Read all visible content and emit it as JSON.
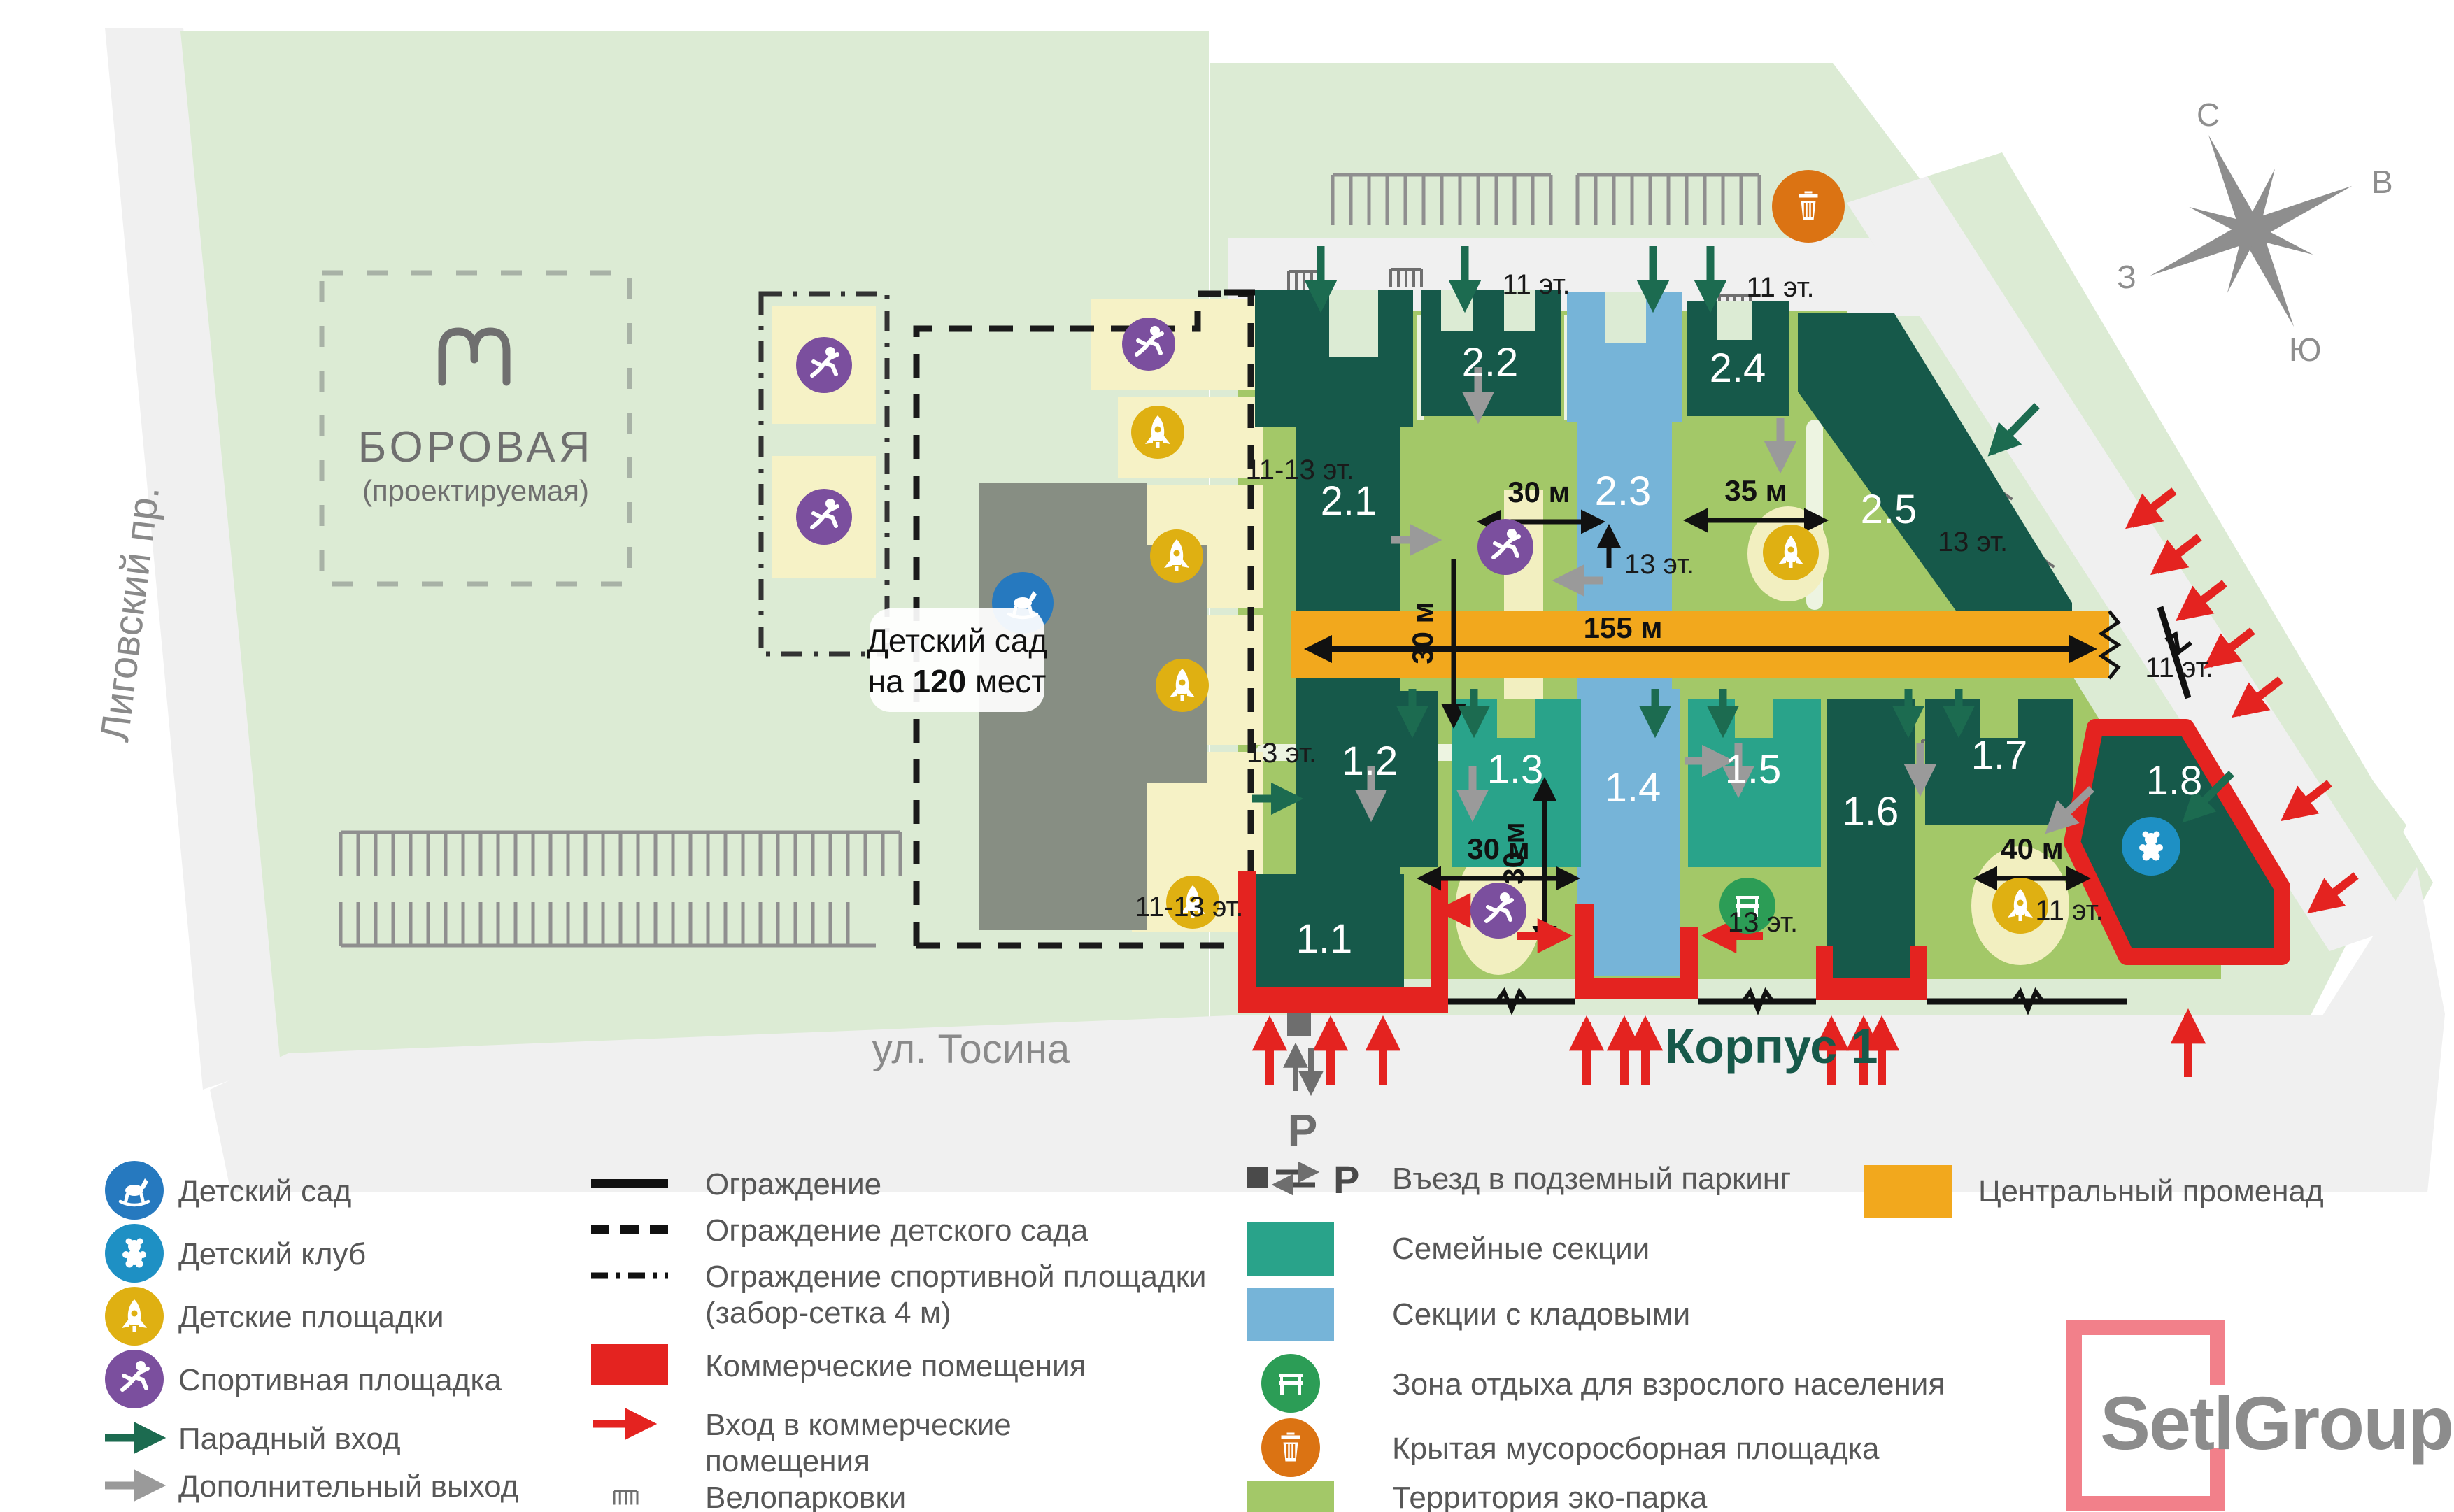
{
  "map": {
    "metro": {
      "name": "БОРОВАЯ",
      "sub": "(проектируемая)"
    },
    "street_left": "Лиговский пр.",
    "street_bottom": "ул. Тосина",
    "korpus": "Корпус 1",
    "kg_line1": "Детский сад",
    "kg_line2a": "на ",
    "kg_line2b": "120",
    "kg_line2c": " мест",
    "parking_letter": "Р",
    "compass": {
      "n": "С",
      "e": "В",
      "s": "Ю",
      "w": "З"
    },
    "building_labels": [
      "2.1",
      "2.2",
      "2.3",
      "2.4",
      "2.5",
      "1.1",
      "1.2",
      "1.3",
      "1.4",
      "1.5",
      "1.6",
      "1.7",
      "1.8"
    ],
    "floor_labels": [
      "11-13 эт.",
      "11-13 эт.",
      "11 эт.",
      "11 эт.",
      "11 эт.",
      "11 эт.",
      "13 эт.",
      "13 эт.",
      "13 эт.",
      "13 эт."
    ],
    "measurements": {
      "m30": "30 м",
      "m35": "35 м",
      "m40": "40 м",
      "m155": "155 м"
    }
  },
  "legend": {
    "col1": [
      {
        "label": "Детский сад"
      },
      {
        "label": "Детский клуб"
      },
      {
        "label": "Детские площадки"
      },
      {
        "label": "Спортивная площадка"
      },
      {
        "label": "Парадный вход"
      },
      {
        "label": "Дополнительный выход"
      }
    ],
    "col2": [
      {
        "label": "Ограждение"
      },
      {
        "label": "Ограждение детского сада"
      },
      {
        "label": "Ограждение спортивной площадки",
        "label2": "(забор-сетка 4 м)"
      },
      {
        "label": "Коммерческие помещения"
      },
      {
        "label": "Вход в коммерческие",
        "label2": "помещения"
      },
      {
        "label": "Велопарковки"
      }
    ],
    "col3": [
      {
        "label": "Въезд в подземный паркинг"
      },
      {
        "label": "Семейные секции"
      },
      {
        "label": "Секции с кладовыми"
      },
      {
        "label": "Зона отдыха для взрослого населения"
      },
      {
        "label": "Крытая мусоросборная площадка"
      },
      {
        "label": "Территория эко-парка"
      }
    ],
    "col4": [
      {
        "label": "Центральный променад"
      }
    ],
    "logo": "SetlGroup"
  },
  "colors": {
    "building_dark": "#16594A",
    "family_teal": "#29A38A",
    "storage_blue": "#76B4D8",
    "promenade": "#F2A81D",
    "commercial_red": "#E42320",
    "eco_green": "#A3C868",
    "pale_green": "#DCEBD4",
    "street_gray": "#F0F0F0",
    "play_yellow": "#DFB012",
    "sport_purple": "#7B4F9E",
    "kg_blue": "#2679BF",
    "club_blue": "#1E90C4",
    "bench_green": "#2C9D56",
    "trash_orange": "#DB7313",
    "logo_pink": "#F2808A"
  }
}
